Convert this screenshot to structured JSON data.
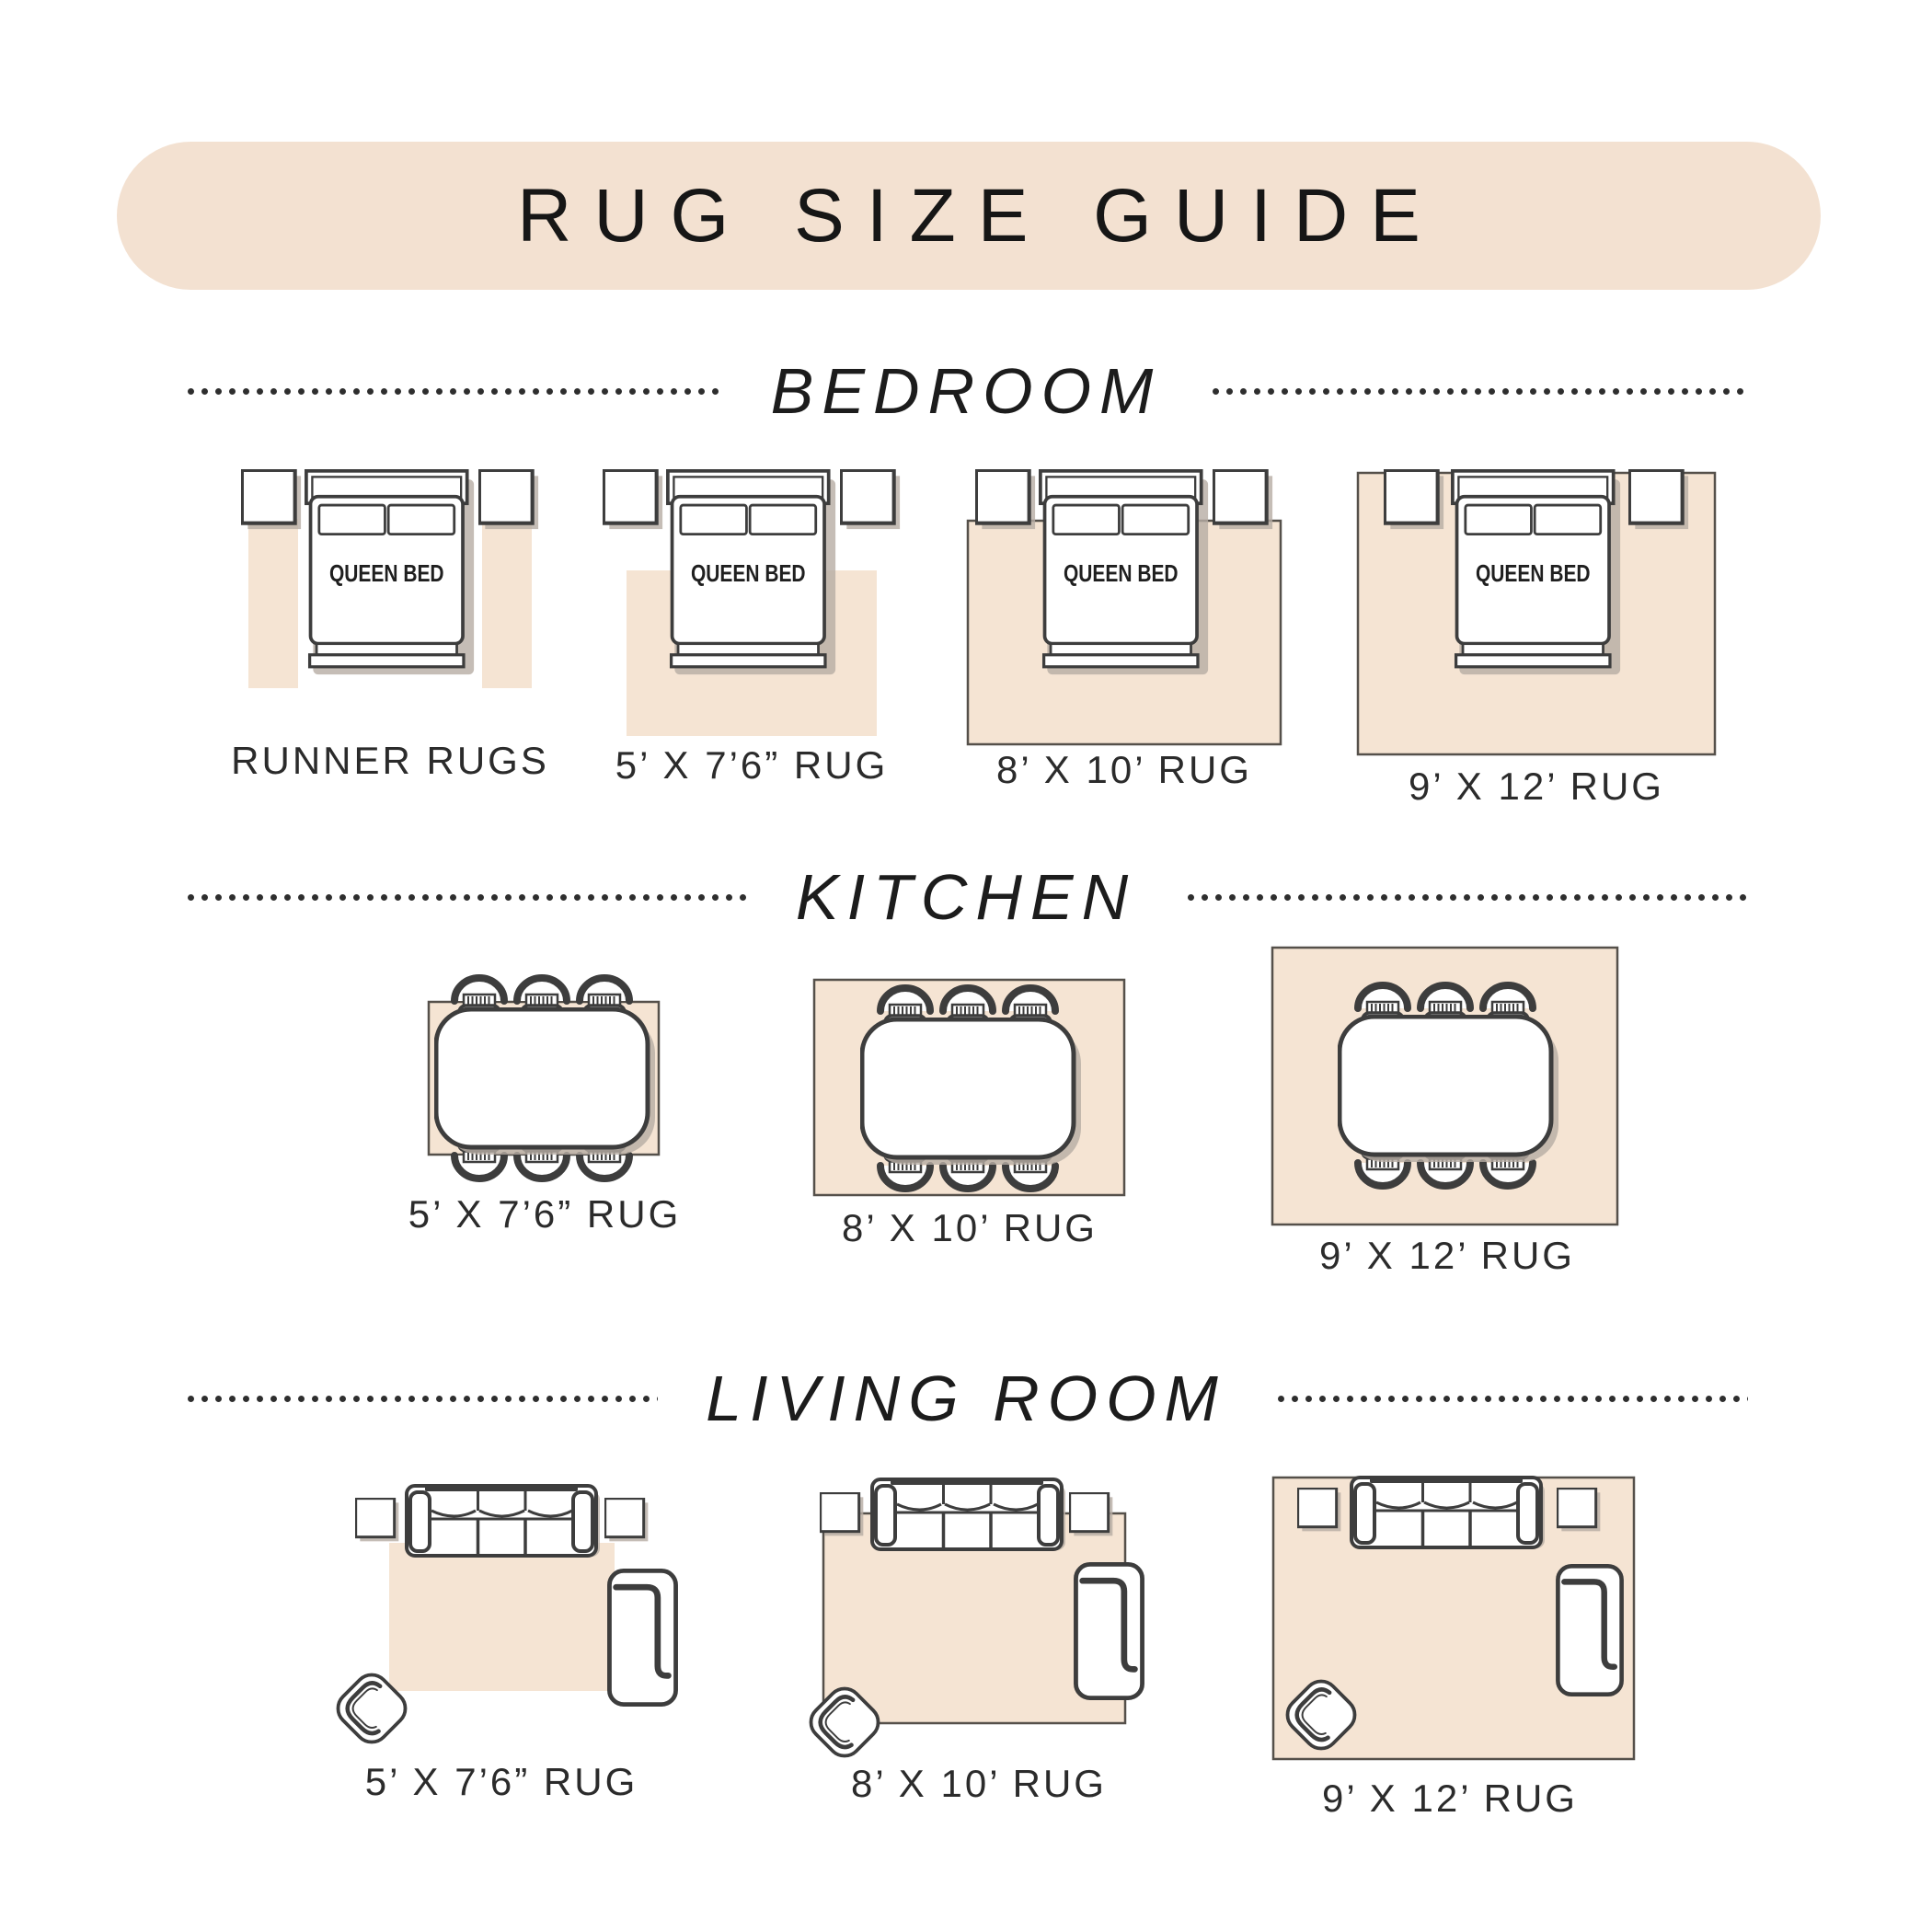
{
  "title": "RUG SIZE GUIDE",
  "furniture": {
    "queen_bed_label": "QUEEN BED"
  },
  "sections": {
    "bedroom": {
      "name": "BEDROOM",
      "items": [
        {
          "label": "RUNNER RUGS"
        },
        {
          "label": "5’ X 7’6” RUG"
        },
        {
          "label": "8’ X 10’ RUG"
        },
        {
          "label": "9’ X 12’ RUG"
        }
      ]
    },
    "kitchen": {
      "name": "KITCHEN",
      "items": [
        {
          "label": "5’ X 7’6” RUG"
        },
        {
          "label": "8’ X 10’ RUG"
        },
        {
          "label": "9’ X 12’ RUG"
        }
      ]
    },
    "living_room": {
      "name": "LIVING ROOM",
      "items": [
        {
          "label": "5’ X 7’6” RUG"
        },
        {
          "label": "8’ X 10’ RUG"
        },
        {
          "label": "9’ X 12’ RUG"
        }
      ]
    }
  },
  "colors": {
    "banner": "#f3e1d1",
    "rug": "#f5e4d3",
    "outline": "#3d3d3d",
    "shadow": "#b6ada4",
    "rug_border": "#55504a",
    "text": "#2b2b2b"
  }
}
